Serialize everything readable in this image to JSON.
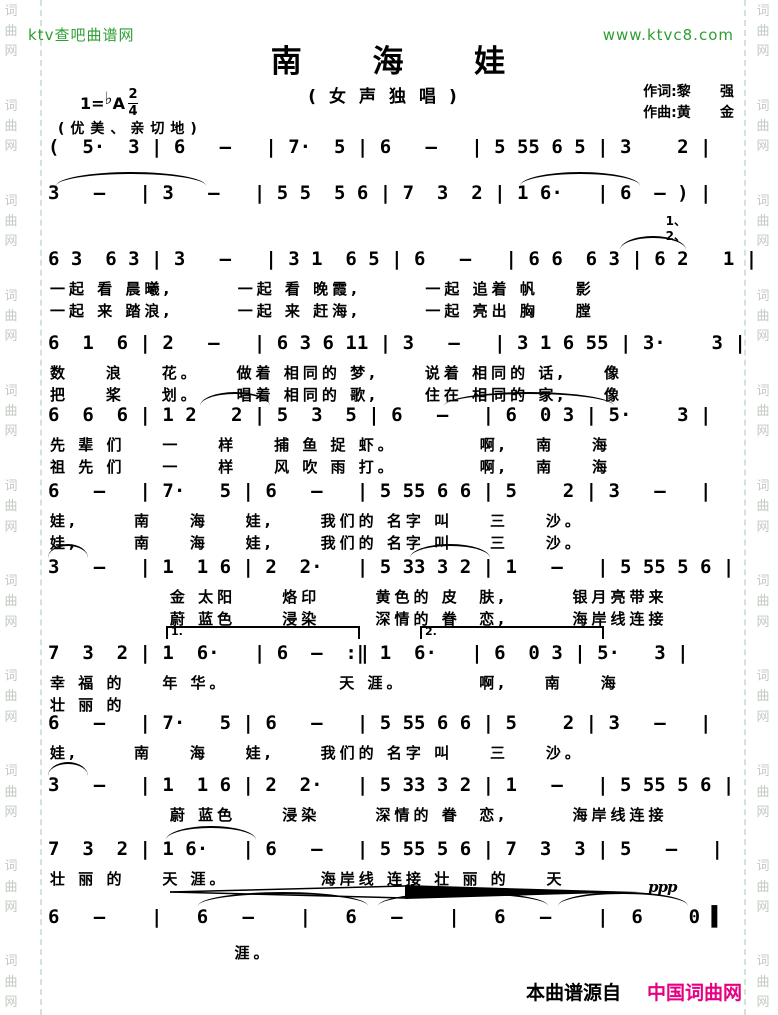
{
  "header": {
    "site_left": "ktv查吧曲谱网",
    "site_right": "www.ktvc8.com"
  },
  "title": "南 海 娃",
  "subtitle": "(女声独唱)",
  "key": {
    "prefix": "1=",
    "flat": "♭",
    "note": "A",
    "meter_num": "2",
    "meter_den": "4"
  },
  "credits": {
    "lyricist": "作词:黎      强",
    "composer": "作曲:黄      金"
  },
  "tempo": "(优美、亲切地)",
  "watermark": {
    "group": "词曲网"
  },
  "music": {
    "s0a": {
      "notes": "(  5·  3 | 6   —   | 7·  5 | 6   —   | 5 55 6 5 | 3    2 |"
    },
    "s0b": {
      "notes": "3   —   | 3   —   | 5 5  5 6 | 7  3  2 | 1 6·   | 6  — ) |"
    },
    "s1": {
      "notes": "6 3  6 3 | 3   —   | 3 1  6 5 | 6   —   | 6 6  6 3 | 6 2   1 |",
      "lyric1": "一起 看 晨曦,       一起 看 晚霞,       一起 追着 帆    影",
      "lyric2": "一起 来 踏浪,       一起 来 赶海,       一起 亮出 胸    膛",
      "verse_marks": [
        "1、",
        "2、"
      ]
    },
    "s2": {
      "notes": "6  1  6 | 2   —   | 6 3 6 11 | 3   —   | 3 1 6 55 | 3·    3 |",
      "lyric1": "数    浪    花。    做着 相同的 梦,     说着 相同的 话,    像",
      "lyric2": "把    桨    划。    唱着 相同的 歌,     住在 相同的 家,    像"
    },
    "s3": {
      "notes": "6  6  6 | 1 2   2 | 5  3  5 | 6   —   | 6  0 3 | 5·    3 |",
      "lyric1": "先 辈 们    一    样    捕 鱼 捉 虾。         啊,   南    海",
      "lyric2": "祖 先 们    一    样    风 吹 雨 打。         啊,   南    海"
    },
    "s4": {
      "notes": "6   —   | 7·   5 | 6   —   | 5 55 6 6 | 5    2 | 3   —   |",
      "lyric1": "娃,      南    海    娃,     我们的 名字 叫    三    沙。",
      "lyric2": "娃,      南    海    娃,     我们的 名字 叫    三    沙。"
    },
    "s5": {
      "notes": "3   —   | 1  1 6 | 2  2·   | 5 33 3 2 | 1   —   | 5 55 5 6 |",
      "lyric1": "             金 太阳     烙印      黄色的 皮  肤,       银月亮带来",
      "lyric2": "             蔚 蓝色     浸染      深情的 眷  恋,       海岸线连接"
    },
    "s6": {
      "notes": "7  3  2 | 1  6·   | 6  —  :‖ 1  6·   | 6  0 3 | 5·   3 |",
      "lyric1": "幸 福 的    年 华。            天 涯。        啊,    南    海",
      "lyric2": "壮 丽 的",
      "volta_first": "1.",
      "volta_second": "2."
    },
    "s7": {
      "notes": "6   —   | 7·   5 | 6   —   | 5 55 6 6 | 5    2 | 3   —   |",
      "lyric1": "娃,      南    海    娃,     我们的 名字 叫    三    沙。"
    },
    "s8": {
      "notes": "3   —   | 1  1 6 | 2  2·   | 5 33 3 2 | 1   —   | 5 55 5 6 |",
      "lyric1": "             蔚 蓝色     浸染      深情的 眷  恋,       海岸线连接"
    },
    "s9": {
      "notes": "7  3  2 | 1 6·   | 6   —   | 5 55 5 6 | 7  3  3 | 5   —   |",
      "lyric1": "壮 丽 的    天 涯。          海岸线 连接 壮 丽 的    天"
    },
    "s10": {
      "notes": "6   —    |   6   —    |   6   —    |   6   —    |  6    0 ▌",
      "lyric1": "                    涯。"
    }
  },
  "dynamics": {
    "ppp": "ppp"
  },
  "footer": {
    "source": "本曲谱源自",
    "brand": "中国词曲网"
  },
  "colors": {
    "accent_green": "#2e9e33",
    "brand_magenta": "#e60082",
    "watermark_gray": "#c2cac2",
    "notation_black": "#000000"
  }
}
